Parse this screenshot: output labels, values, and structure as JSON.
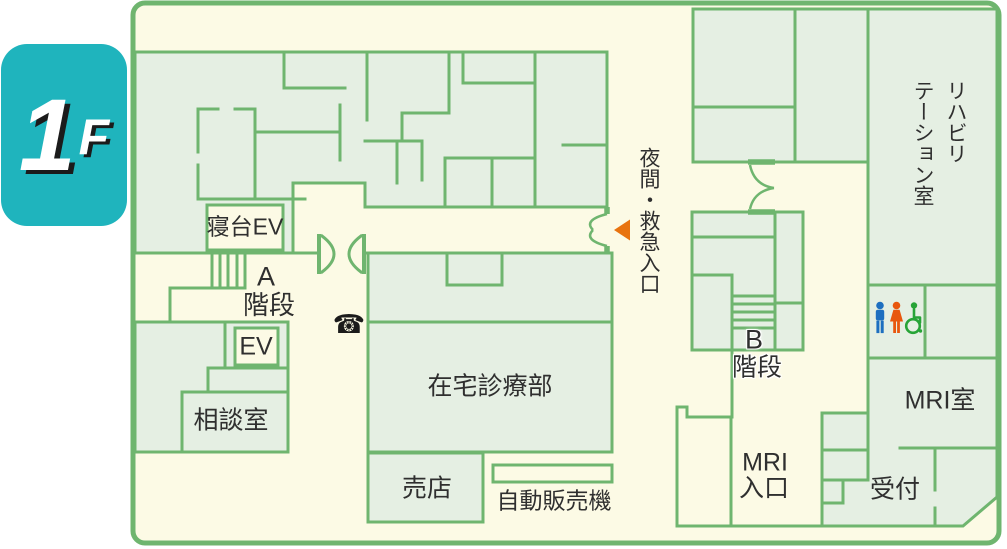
{
  "floor_badge": {
    "number": "1",
    "suffix": "F",
    "bg_color": "#1fb4bd",
    "text_color": "#ffffff",
    "text_shadow_color": "#1b1b1b"
  },
  "map": {
    "colors": {
      "background": "#fcfae5",
      "room_fill": "#e5efe3",
      "wall": "#6fb56f",
      "label_text": "#2f2f2f"
    },
    "rooms": {
      "bed_elevator": "寝台EV",
      "stairs_a_letter": "A",
      "stairs_a_word": "階段",
      "elevator": "EV",
      "consultation_room": "相談室",
      "home_care_department": "在宅診療部",
      "shop": "売店",
      "vending_machine": "自動販売機",
      "stairs_b_letter": "B",
      "stairs_b_word": "階段",
      "rehabilitation_room": "リハビリ\nテーション室",
      "mri_room": "MRI室",
      "mri_entrance_line1": "MRI",
      "mri_entrance_line2": "入口",
      "reception": "受付"
    },
    "entrance": {
      "label": "夜間・救急入口",
      "arrow_color": "#e8730f"
    },
    "icons": {
      "phone": "☎",
      "restroom_man_color": "#1d6fc0",
      "restroom_woman_color": "#e8570e",
      "restroom_wheelchair_color": "#27a437"
    }
  }
}
